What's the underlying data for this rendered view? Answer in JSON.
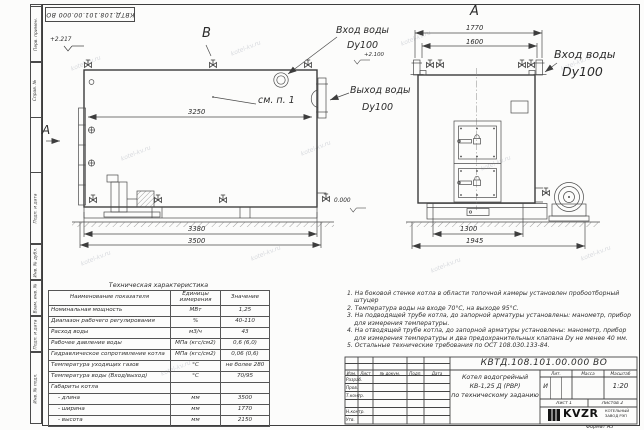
{
  "watermark": {
    "text": "kotel-kv.ru"
  },
  "margin_labels": {
    "perv": "Перв. примен.",
    "sprav": "Справ. №",
    "podp1": "Подп. и дата",
    "inv_dubl": "Инв. № дубл.",
    "vzam": "Взам. инв. №",
    "podp2": "Подп. и дата",
    "inv_podl": "Инв. № подл."
  },
  "side_view": {
    "view_label": "B",
    "section_label": "A",
    "see_item": "см. п. 1",
    "elev_top": "+2.217",
    "inlet_label1": "Вход воды",
    "inlet_label2": "Dy100",
    "inlet_elev": "+2.100",
    "outlet_label1": "Выход воды",
    "outlet_label2": "Dy100",
    "dim_inner": "3250",
    "dim_base": "3380",
    "dim_overall": "3500"
  },
  "front_view": {
    "view_label": "A",
    "dim_width_outer": "1770",
    "dim_width_inner": "1600",
    "inlet_label1": "Вход воды",
    "inlet_label2": "Dy100",
    "elev_zero": "0.000",
    "dim_base": "1300",
    "dim_overall": "1945"
  },
  "spec_table": {
    "title": "Техническая характеристика",
    "col_name": "Наименование показателя",
    "col_units": "Единицы измерения",
    "col_value": "Значение",
    "rows": [
      {
        "name": "Номинальная мощность",
        "units": "МВт",
        "value": "1,25"
      },
      {
        "name": "Диапазон рабочего регулирования",
        "units": "%",
        "value": "40-110"
      },
      {
        "name": "Расход воды",
        "units": "м3/ч",
        "value": "43"
      },
      {
        "name": "Рабочее давление воды",
        "units": "МПа (кгс/см2)",
        "value": "0,6 (6,0)"
      },
      {
        "name": "Гидравлическое сопротивление котла",
        "units": "МПа (кгс/см2)",
        "value": "0,06 (0,6)"
      },
      {
        "name": "Температура уходящих газов",
        "units": "°С",
        "value": "не более 280"
      },
      {
        "name": "Температура воды (Вход/выход)",
        "units": "°С",
        "value": "70/95"
      },
      {
        "name": "Габариты котла",
        "units": "",
        "value": ""
      },
      {
        "name": "- длина",
        "units": "мм",
        "value": "3500"
      },
      {
        "name": "- ширина",
        "units": "мм",
        "value": "1770"
      },
      {
        "name": "- высота",
        "units": "мм",
        "value": "2150"
      }
    ]
  },
  "notes": {
    "items": [
      "1. На боковой стенке котла в области топочной камеры установлен пробоотборный штуцер",
      "2. Температура воды на входе 70°С, на выходе 95°С.",
      "3. На подводящей трубе котла, до запорной арматуры установлены: манометр, прибор для измерения температуры.",
      "4. На отводящей трубе котла, до запорной арматуры установлены: манометр, прибор для измерения температуры и два предохранительных клапана Dу не менее 40 мм.",
      "5. Остальные технические требования по ОСТ 108.030.133-84."
    ]
  },
  "title_block": {
    "doc_number": "КВТД.108.101.00.000  ВО",
    "header_izm": "Изм.",
    "header_list": "Лист",
    "header_doc": "№ докум.",
    "header_podp": "Подп.",
    "header_data": "Дата",
    "row_razrab": "Разраб.",
    "row_prov": "Пров.",
    "row_tkontr": "Т.контр.",
    "row_nkontr": "Н.контр.",
    "row_utv": "Утв.",
    "name_line1": "Котел водогрейный",
    "name_line2": "КВ-1,25 Д (РВР)",
    "name_line3": "по техническому заданию",
    "lit_label": "Лит.",
    "lit_value": "И",
    "mass_label": "Масса",
    "scale_label": "Масштаб",
    "scale_value": "1:20",
    "sheet_label": "Лист 1",
    "sheets_label": "Листов 2",
    "logo_text": "KVZR",
    "logo_sub1": "КОТЕЛЬНЫЙ",
    "logo_sub2": "ЗАВОД РЭП",
    "format_label": "Формат А3"
  }
}
